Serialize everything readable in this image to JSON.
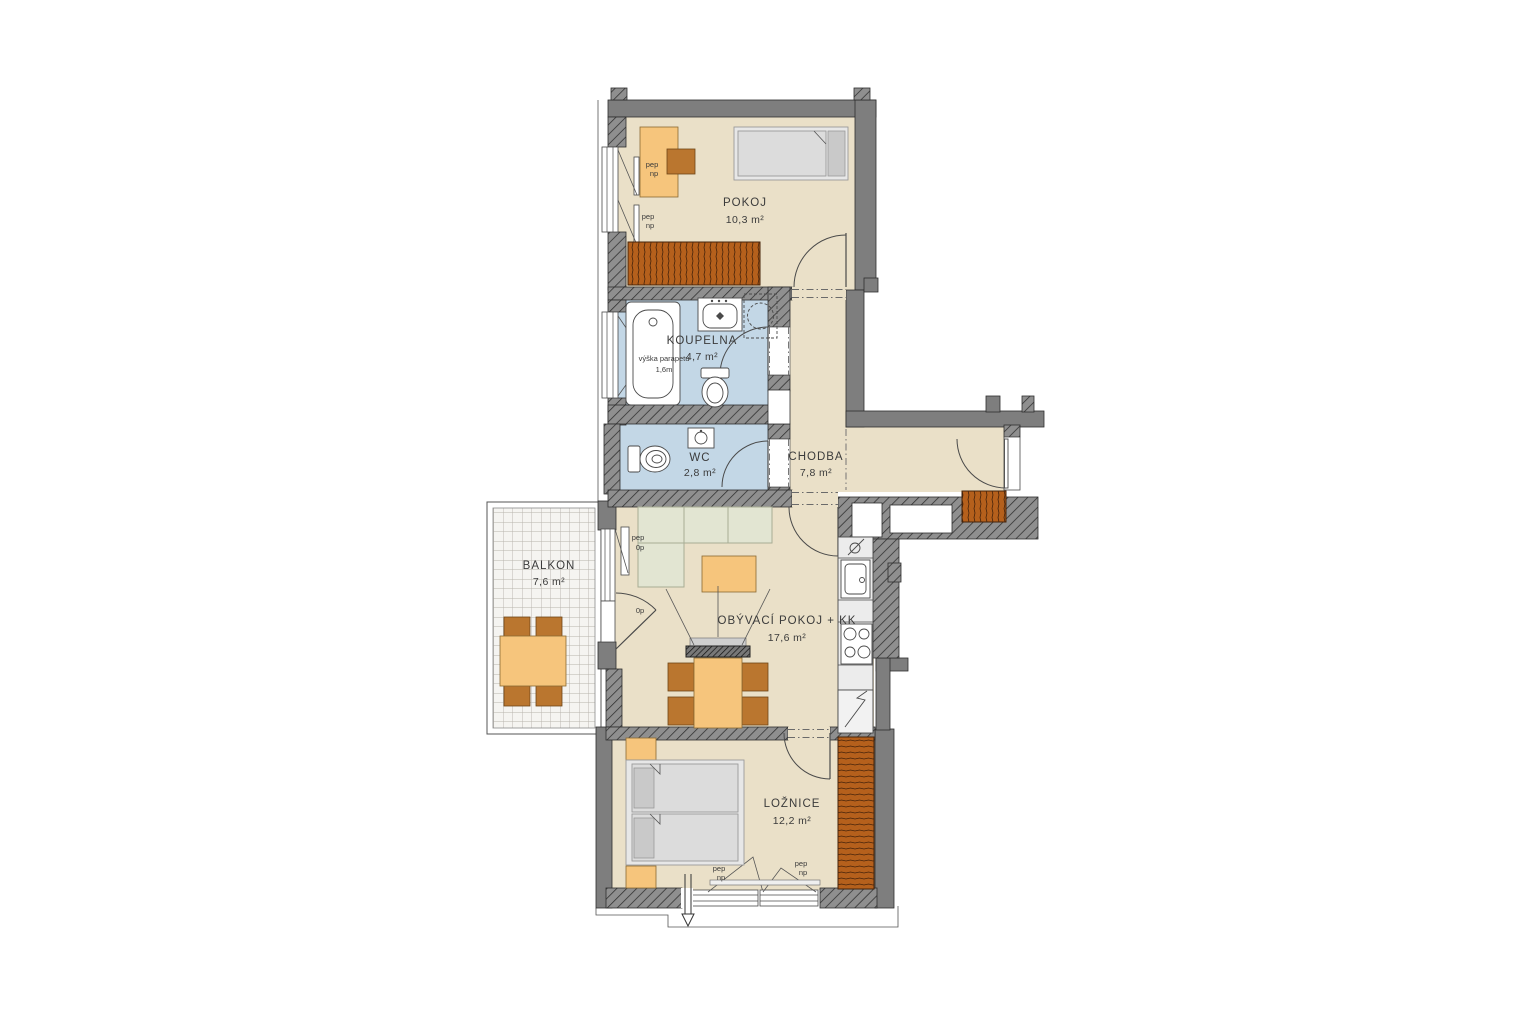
{
  "plan": {
    "rooms": [
      {
        "id": "pokoj",
        "name": "POKOJ",
        "area": "10,3 m²"
      },
      {
        "id": "koupelna",
        "name": "KOUPELNA",
        "area": "4,7 m²"
      },
      {
        "id": "wc",
        "name": "WC",
        "area": "2,8 m²"
      },
      {
        "id": "chodba",
        "name": "CHODBA",
        "area": "7,8 m²"
      },
      {
        "id": "obyvaci",
        "name": "OBÝVACÍ POKOJ + KK",
        "area": "17,6 m²"
      },
      {
        "id": "loznice",
        "name": "LOŽNICE",
        "area": "12,2 m²"
      },
      {
        "id": "balkon",
        "name": "BALKON",
        "area": "7,6 m²"
      }
    ],
    "annotations": {
      "pep": "pep",
      "np": "np",
      "op": "0p",
      "sill_height_line1": "výška parapetu",
      "sill_height_line2": "1,6m"
    },
    "colors": {
      "wall_solid": "#7e7e7e",
      "wall_hatched": "#8f8f8f",
      "floor": "#EAE0C8",
      "wet_room": "#C3D7E6",
      "furniture_light": "#F6C57C",
      "furniture_wood": "#B5601C",
      "furniture_chair": "#BA762F",
      "sofa": "#E2E5D2",
      "background": "#FFFFFF"
    }
  }
}
